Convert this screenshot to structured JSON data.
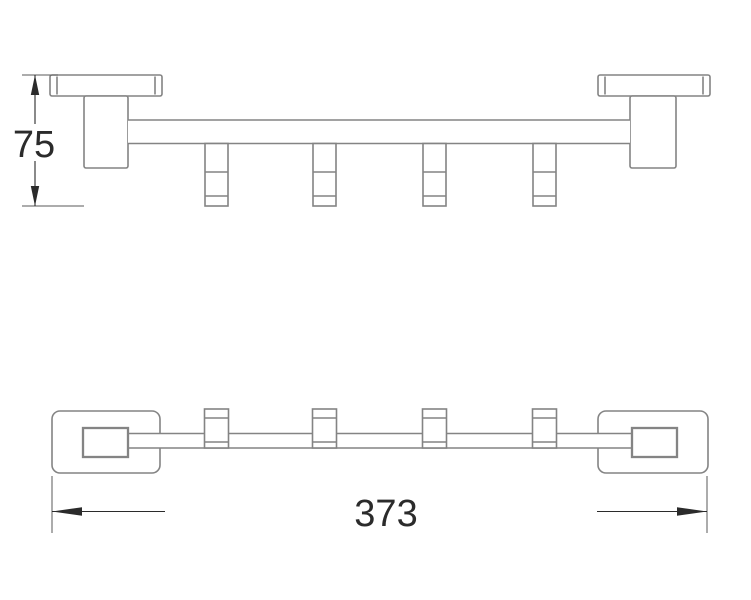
{
  "diagram": {
    "kind": "technical-drawing",
    "subject": "towel bar with hooks, two orthographic views",
    "hook_count": 4,
    "dimensions": {
      "height_label": "75",
      "width_label": "373"
    },
    "colors": {
      "outline": "#848484",
      "dimension": "#2b2b2b",
      "background": "#ffffff"
    }
  }
}
